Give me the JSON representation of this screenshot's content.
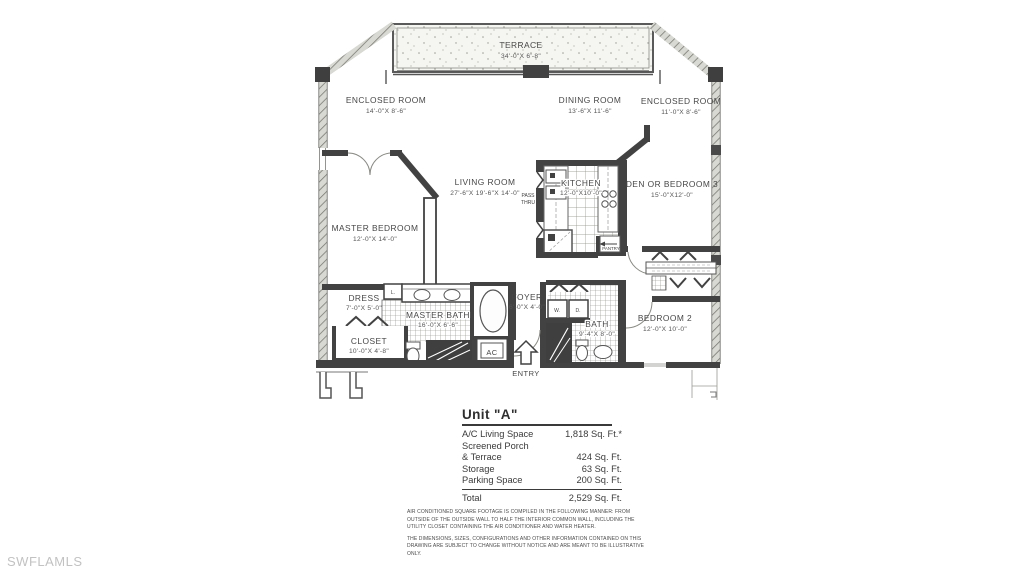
{
  "watermark": "SWFLAMLS",
  "colors": {
    "ink": "#424242",
    "hatch": "#76766f",
    "watermark": "#c2c2c2",
    "paper": "#ffffff"
  },
  "plan": {
    "rooms": {
      "terrace": {
        "name": "TERRACE",
        "dims": "34'-0\"X 6'-8\""
      },
      "enclosed_left": {
        "name": "ENCLOSED ROOM",
        "dims": "14'-0\"X 8'-6\""
      },
      "dining": {
        "name": "DINING ROOM",
        "dims": "13'-6\"X 11'-6\""
      },
      "enclosed_right": {
        "name": "ENCLOSED ROOM",
        "dims": "11'-0\"X 8'-6\""
      },
      "living": {
        "name": "LIVING ROOM",
        "dims": "27'-6\"X 19'-6\"X 14'-0\""
      },
      "kitchen": {
        "name": "KITCHEN",
        "dims": "12'-0\"X10'-0\""
      },
      "den": {
        "name": "DEN OR BEDROOM 3",
        "dims": "15'-0\"X12'-0\""
      },
      "master_bedroom": {
        "name": "MASTER BEDROOM",
        "dims": "12'-0\"X 14'-0\""
      },
      "dress": {
        "name": "DRESS",
        "dims": "7'-0\"X 5'-0\""
      },
      "master_bath": {
        "name": "MASTER BATH",
        "dims": "16'-0\"X 6'-6\""
      },
      "closet": {
        "name": "CLOSET",
        "dims": "10'-0\"X 4'-8\""
      },
      "foyer": {
        "name": "FOYER",
        "dims": "6'-0\"X 4'-0\""
      },
      "bath": {
        "name": "BATH",
        "dims": "9'-4\"X 8'-0\""
      },
      "bedroom2": {
        "name": "BEDROOM 2",
        "dims": "12'-0\"X 10'-0\""
      }
    },
    "annotations": {
      "entry": "ENTRY",
      "ac": "AC",
      "pantry": "PANTRY",
      "pass1": "PASS",
      "pass2": "THRU",
      "washer": "W.",
      "dryer": "D.",
      "linen": "L."
    }
  },
  "summary": {
    "title": "Unit \"A\"",
    "rows": [
      {
        "label": "A/C Living Space",
        "value": "1,818 Sq. Ft.*"
      },
      {
        "label": "Screened Porch",
        "value": ""
      },
      {
        "label": "& Terrace",
        "value": "424 Sq. Ft."
      },
      {
        "label": "Storage",
        "value": "63 Sq. Ft."
      },
      {
        "label": "Parking Space",
        "value": "200 Sq. Ft."
      }
    ],
    "total": {
      "label": "Total",
      "value": "2,529 Sq. Ft."
    }
  },
  "disclaimer": {
    "p1": "AIR CONDITIONED SQUARE FOOTAGE IS COMPILED IN THE FOLLOWING MANNER: FROM OUTSIDE OF THE OUTSIDE WALL TO HALF THE INTERIOR COMMON WALL, INCLUDING THE UTILITY CLOSET CONTAINING THE AIR CONDITIONER AND WATER HEATER.",
    "p2": "THE DIMENSIONS, SIZES, CONFIGURATIONS AND OTHER INFORMATION CONTAINED ON THIS DRAWING ARE SUBJECT TO CHANGE WITHOUT NOTICE AND ARE MEANT TO BE ILLUSTRATIVE ONLY."
  }
}
